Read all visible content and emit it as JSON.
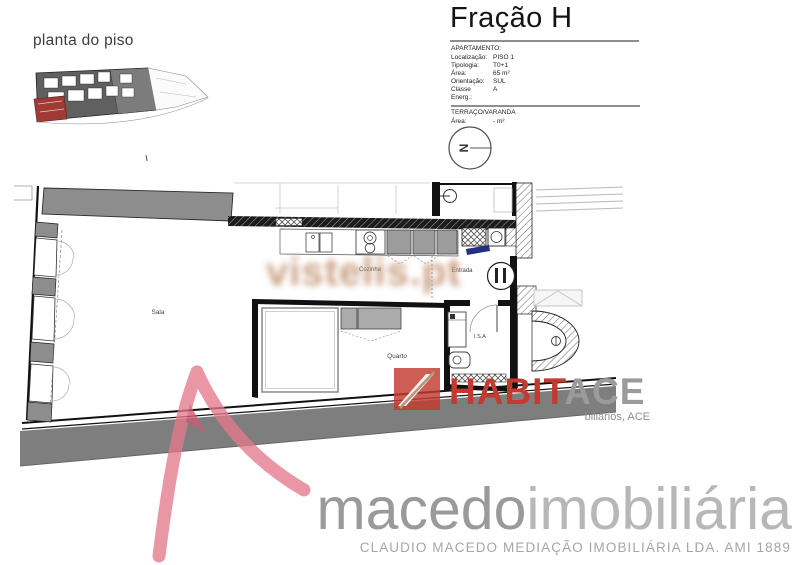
{
  "header": {
    "plan_label": "planta do piso",
    "title": "Fração H"
  },
  "info_panel": {
    "apartment_heading": "APARTAMENTO:",
    "rows": [
      {
        "label": "Localização:",
        "value": "PISO 1"
      },
      {
        "label": "Tipologia:",
        "value": "T0+1"
      },
      {
        "label": "Área:",
        "value": "65 m²"
      },
      {
        "label": "Orientação:",
        "value": "SUL"
      },
      {
        "label": "Classe Energ.:",
        "value": "A"
      }
    ],
    "terrace_heading": "TERRAÇO/VARANDA",
    "terrace_row": {
      "label": "Área:",
      "value": "- m²"
    }
  },
  "north_arrow": {
    "letter": "N"
  },
  "floorplan": {
    "labels": {
      "sala": "Sala",
      "cozinha": "Cozinha",
      "entrada": "Entrada",
      "quarto": "Quarto",
      "isa": "I.S.A"
    }
  },
  "watermark": {
    "text": "vistelis.pt"
  },
  "habitace_logo": {
    "text_red": "HABIT",
    "text_gray": "ACE",
    "subtitle": "biliários, ACE"
  },
  "macedo_logo": {
    "brand_primary": "macedo",
    "brand_secondary": "imobiliária",
    "tagline": "CLAUDIO MACEDO MEDIAÇÃO IMOBILIÁRIA LDA. AMI 1889"
  },
  "colors": {
    "habitace_red": "#c23a30",
    "macedo_pink": "#e4798d",
    "watermark_beige": "#c69b7c",
    "site_highlight_red": "#a03a34",
    "wall_gray": "#8d8d8d"
  }
}
